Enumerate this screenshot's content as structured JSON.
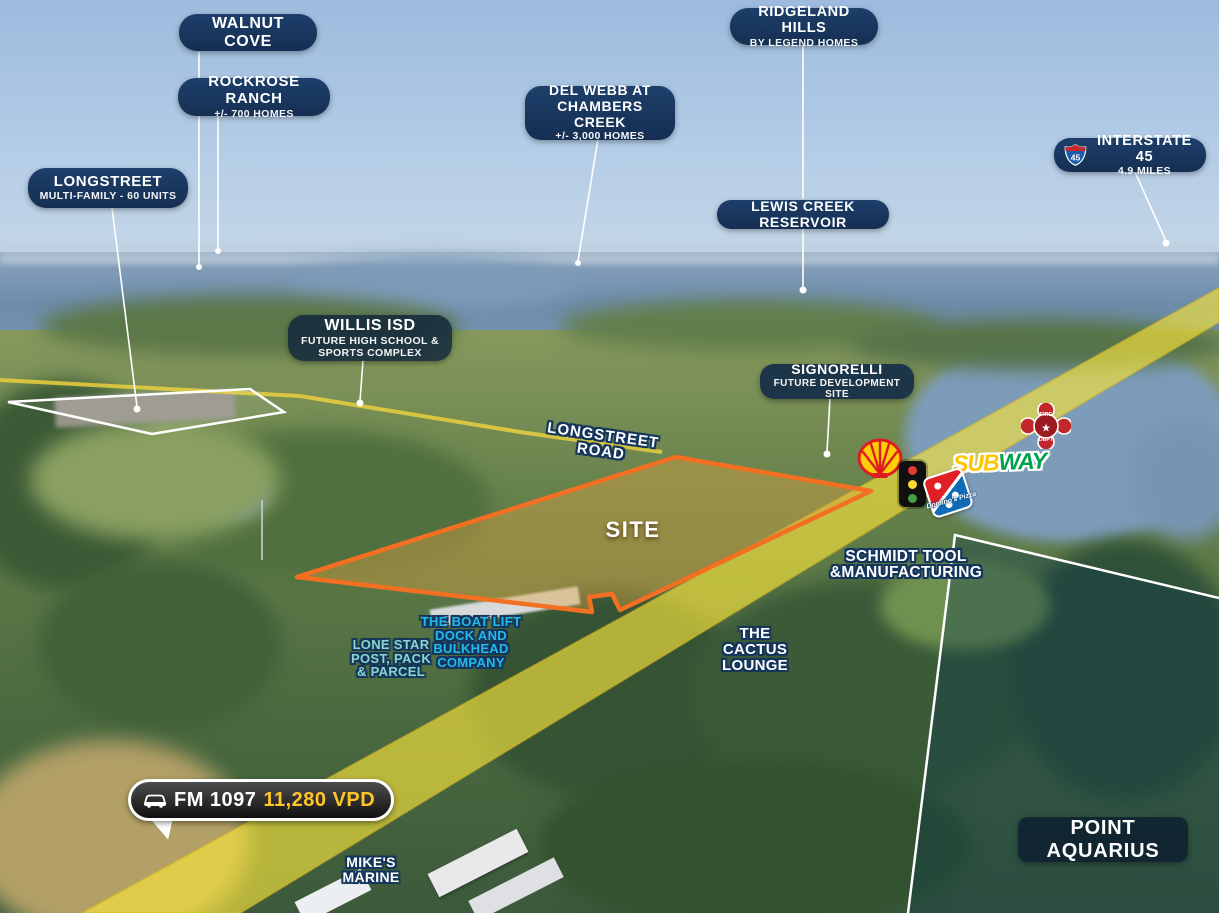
{
  "chips": {
    "walnut_cove": {
      "title": "WALNUT COVE"
    },
    "rockrose_ranch": {
      "title": "ROCKROSE RANCH",
      "subtitle": "+/- 700 HOMES"
    },
    "longstreet": {
      "title": "LONGSTREET",
      "subtitle": "MULTI-FAMILY - 60 UNITS"
    },
    "del_webb": {
      "title": "DEL WEBB AT\nCHAMBERS CREEK",
      "subtitle": "+/- 3,000 HOMES"
    },
    "ridgeland_hills": {
      "title": "RIDGELAND HILLS",
      "subtitle": "BY LEGEND HOMES"
    },
    "lewis_creek": {
      "title": "LEWIS CREEK RESERVOIR"
    },
    "interstate_45": {
      "shield": "45",
      "title": "INTERSTATE 45",
      "subtitle": "4.9 MILES"
    },
    "willis_isd": {
      "title": "WILLIS ISD",
      "subtitle": "FUTURE HIGH SCHOOL &\nSPORTS COMPLEX"
    },
    "signorelli": {
      "title": "SIGNORELLI",
      "subtitle": "FUTURE DEVELOPMENT SITE"
    },
    "point_aquarius": {
      "title": "POINT AQUARIUS"
    }
  },
  "map_labels": {
    "longstreet_road": "LONGSTREET ROAD",
    "site": "SITE",
    "schmidt_tool": "SCHMIDT TOOL\n&MANUFACTURING",
    "boat_lift": "THE BOAT LIFT\nDOCK AND\nBULKHEAD\nCOMPANY",
    "lone_star": "LONE STAR\nPOST, PACK\n& PARCEL",
    "cactus_lounge": "THE\nCACTUS\nLOUNGE",
    "mikes_marine": "MIKE'S\nMARINE"
  },
  "traffic_badge": {
    "road": "FM 1097",
    "count": "11,280 VPD"
  },
  "logos": {
    "subway_sub": "SUB",
    "subway_way": "WAY",
    "dominos": "Domino's Pizza",
    "fire_dept_top": "FIRE",
    "fire_dept_bottom": "DEPT"
  },
  "colors": {
    "chip_bg": "#17345a",
    "accent_orange": "#f36f21",
    "road_yellow": "#f7e43c",
    "gold": "#ffc527",
    "boat_lift_cyan": "#23b9ea",
    "lone_star_teal": "#8ad6cd",
    "subway_yellow": "#ffc600",
    "subway_green": "#00a14b",
    "dominos_blue": "#0f6cb6",
    "dominos_red": "#e01f26",
    "shell_red": "#dd1d21",
    "shell_yellow": "#fbce07",
    "fire_red": "#c1272d"
  }
}
